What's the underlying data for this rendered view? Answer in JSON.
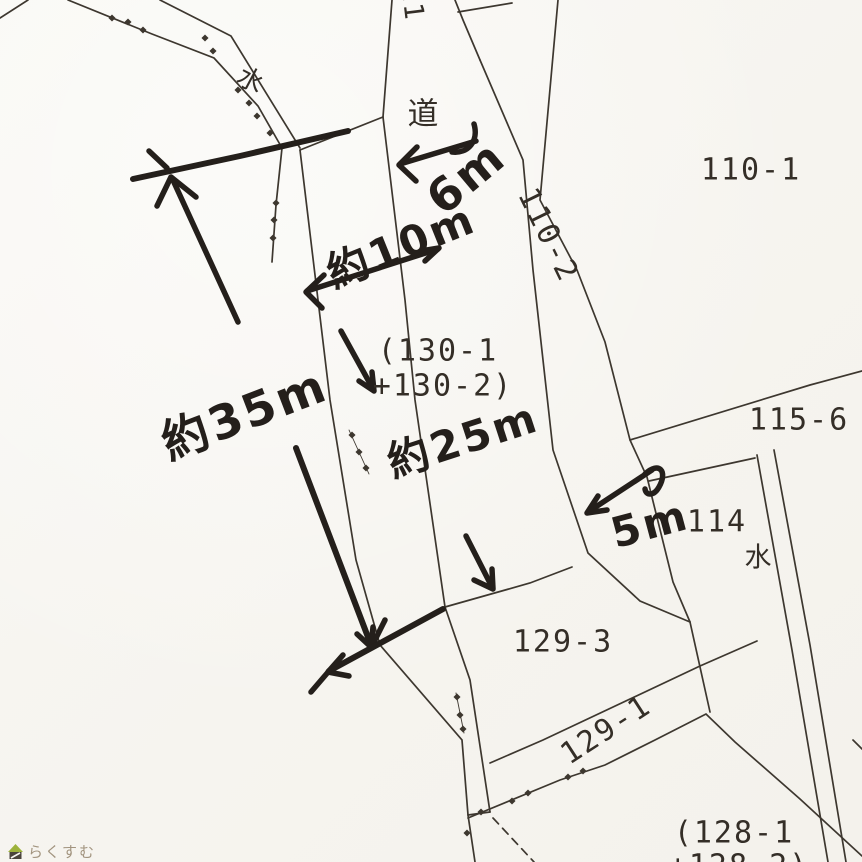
{
  "map": {
    "description": "scanned cadastral parcel map with handwritten survey measurements",
    "road_label": "道",
    "parcels_visible": [
      "110-1",
      "110-2",
      "115-6",
      "114",
      "129-3",
      "129-1",
      "(130-1 +130-2)",
      "(128-1 +128-2)"
    ],
    "water_marks": [
      "水",
      "水"
    ]
  },
  "colors": {
    "paper": "#f7f5f0",
    "printed_ink": "#342e27",
    "handwritten_ink": "#241f1b",
    "logo_text": "#a2947f",
    "logo_roof": "#9db23b",
    "logo_base": "#4a443c"
  },
  "printed_labels": [
    {
      "id": "road-label",
      "text": "道",
      "x": 424,
      "y": 111,
      "rot": 0,
      "size": 31
    },
    {
      "id": "parcel-110-1",
      "text": "110-1",
      "x": 751,
      "y": 170,
      "rot": 0,
      "size": 30
    },
    {
      "id": "parcel-110-2",
      "text": "110-2",
      "x": 548,
      "y": 235,
      "rot": 64,
      "size": 30
    },
    {
      "id": "parcel-130-line1",
      "text": "(130-1",
      "x": 438,
      "y": 351,
      "rot": 0,
      "size": 30
    },
    {
      "id": "parcel-130-line2",
      "text": "+130-2)",
      "x": 443,
      "y": 386,
      "rot": 0,
      "size": 30
    },
    {
      "id": "parcel-115-6",
      "text": "115-6",
      "x": 799,
      "y": 420,
      "rot": 0,
      "size": 30
    },
    {
      "id": "parcel-114",
      "text": "114",
      "x": 717,
      "y": 522,
      "rot": 0,
      "size": 30
    },
    {
      "id": "water-label-right",
      "text": "水",
      "x": 759,
      "y": 555,
      "rot": 0,
      "size": 27
    },
    {
      "id": "water-label-top",
      "text": "水",
      "x": 252,
      "y": 79,
      "rot": 28,
      "size": 26
    },
    {
      "id": "parcel-129-3",
      "text": "129-3",
      "x": 563,
      "y": 642,
      "rot": 0,
      "size": 30
    },
    {
      "id": "parcel-129-1",
      "text": "129-1",
      "x": 606,
      "y": 730,
      "rot": -33,
      "size": 30
    },
    {
      "id": "parcel-128-line1",
      "text": "(128-1",
      "x": 734,
      "y": 833,
      "rot": 0,
      "size": 30
    },
    {
      "id": "parcel-128-line2",
      "text": "+128-2)",
      "x": 739,
      "y": 866,
      "rot": 0,
      "size": 30
    },
    {
      "id": "cutoff-label-top",
      "text": "11",
      "x": 412,
      "y": 3,
      "rot": 83,
      "size": 27
    }
  ],
  "handwritten_notes": [
    {
      "id": "note-6m",
      "text": "6m",
      "x": 466,
      "y": 177,
      "rot": -40,
      "size": 46
    },
    {
      "id": "note-10m",
      "text": "約10m",
      "x": 400,
      "y": 243,
      "rot": -22,
      "size": 42
    },
    {
      "id": "note-35m",
      "text": "約35m",
      "x": 243,
      "y": 410,
      "rot": -21,
      "size": 47
    },
    {
      "id": "note-25m",
      "text": "約25m",
      "x": 462,
      "y": 437,
      "rot": -18,
      "size": 42
    },
    {
      "id": "note-5m",
      "text": "5m",
      "x": 650,
      "y": 524,
      "rot": -15,
      "size": 42
    }
  ],
  "logo": {
    "text": "らくすむ",
    "icon": "house"
  }
}
